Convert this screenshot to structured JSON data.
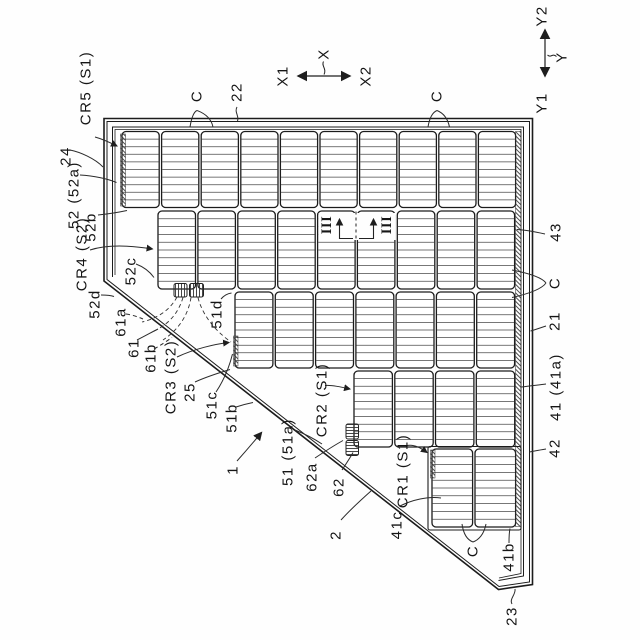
{
  "figure": {
    "type": "patent-line-drawing",
    "axes": {
      "x": {
        "label": "X",
        "neg": "X1",
        "pos": "X2"
      },
      "y": {
        "label": "Y",
        "pos": "Y2",
        "neg": "Y1"
      }
    },
    "labels": {
      "cr5": "CR5 (S1)",
      "n24": "24",
      "s52_52a": "52 (52a)",
      "s52b": "52b",
      "cr4": "CR4 (S2)",
      "s52c": "52c",
      "s52d": "52d",
      "s61a": "61a",
      "s61": "61",
      "s61b": "61b",
      "cr3": "CR3 (S2)",
      "n25": "25",
      "s51c": "51c",
      "s51d": "51d",
      "s51b": "51b",
      "n1": "1",
      "s51_51a": "51 (51a)",
      "s62a": "62a",
      "s62": "62",
      "n2": "2",
      "cr2": "CR2 (S1)",
      "cr1": "CR1 (S1)",
      "s41c": "41c",
      "s41b": "41b",
      "n23": "23",
      "s42": "42",
      "s41_41a": "41 (41a)",
      "s21": "21",
      "s43": "43",
      "n22": "22",
      "c_top_left": "C",
      "c_top_right": "C",
      "c_right": "C",
      "c_bottom": "C",
      "section_left": "III",
      "section_right": "III"
    },
    "panel_rows": [
      {
        "name": "CR5",
        "x": 121,
        "y": 131.5,
        "w": 396,
        "h": 76,
        "panels": 10,
        "stripes": 9
      },
      {
        "name": "CR4",
        "x": 157,
        "y": 211,
        "w": 359,
        "h": 78,
        "panels": 9,
        "stripes": 9
      },
      {
        "name": "CR3",
        "x": 234,
        "y": 292,
        "w": 282,
        "h": 76,
        "panels": 7,
        "stripes": 9
      },
      {
        "name": "CR2",
        "x": 353,
        "y": 371,
        "w": 163,
        "h": 76,
        "panels": 4,
        "stripes": 9
      },
      {
        "name": "CR1",
        "x": 431,
        "y": 449,
        "w": 86,
        "h": 78,
        "panels": 2,
        "stripes": 9
      }
    ]
  }
}
